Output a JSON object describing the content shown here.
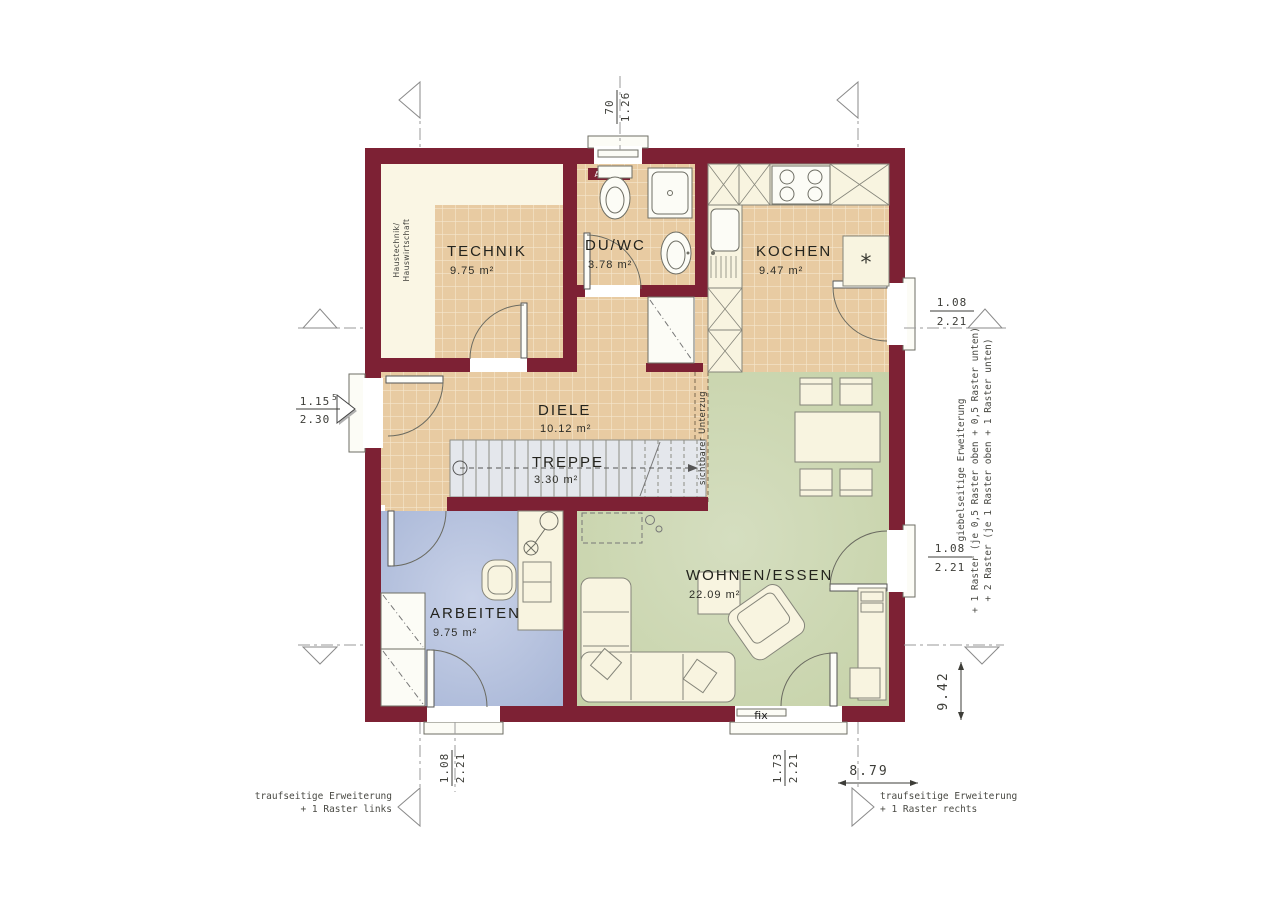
{
  "plan": {
    "rooms": [
      {
        "name": "TECHNIK",
        "area": "9.75 m²"
      },
      {
        "name": "DU/WC",
        "area": "3.78 m²"
      },
      {
        "name": "KOCHEN",
        "area": "9.47 m²"
      },
      {
        "name": "DIELE",
        "area": "10.12 m²"
      },
      {
        "name": "TREPPE",
        "area": "3.30 m²"
      },
      {
        "name": "ARBEITEN",
        "area": "9.75 m²"
      },
      {
        "name": "WOHNEN/ESSEN",
        "area": "22.09 m²"
      }
    ],
    "labels": {
      "ablage": "Ablage",
      "fix": "fix",
      "unterzug": "sichtbarer Unterzug",
      "haustechnik_line1": "Haustechnik/",
      "haustechnik_line2": "Hauswirtschaft",
      "fridge_symbol": "*"
    },
    "dimensions": {
      "top_width": "70",
      "top_height": "1.26",
      "entrance_width": "1.15",
      "entrance_width_sup": "5",
      "entrance_height": "2.30",
      "right_top_width": "1.08",
      "right_top_height": "2.21",
      "right_bottom_width": "1.08",
      "right_bottom_height": "2.21",
      "bottom_left_width": "1.08",
      "bottom_left_height": "2.21",
      "bottom_right_width": "1.73",
      "bottom_right_height": "2.21",
      "total_width": "8.79",
      "total_depth": "9.42"
    },
    "notes": {
      "gable_line1": "giebelseitige Erweiterung",
      "gable_line2": "+ 1 Raster (je 0,5 Raster oben + 0,5 Raster unten)",
      "gable_line3": "+ 2 Raster (je 1 Raster oben + 1 Raster unten)",
      "eaves_left_line1": "traufseitige Erweiterung",
      "eaves_left_line2": "+ 1 Raster links",
      "eaves_right_line1": "traufseitige Erweiterung",
      "eaves_right_line2": "+ 1 Raster rechts"
    },
    "colors": {
      "wall": "#7d2134",
      "tile": "#e8cba2",
      "living": "#c9d5ad",
      "work": "#aebcd9",
      "cream": "#faf6e4",
      "stairs": "#e4e7ec"
    }
  }
}
